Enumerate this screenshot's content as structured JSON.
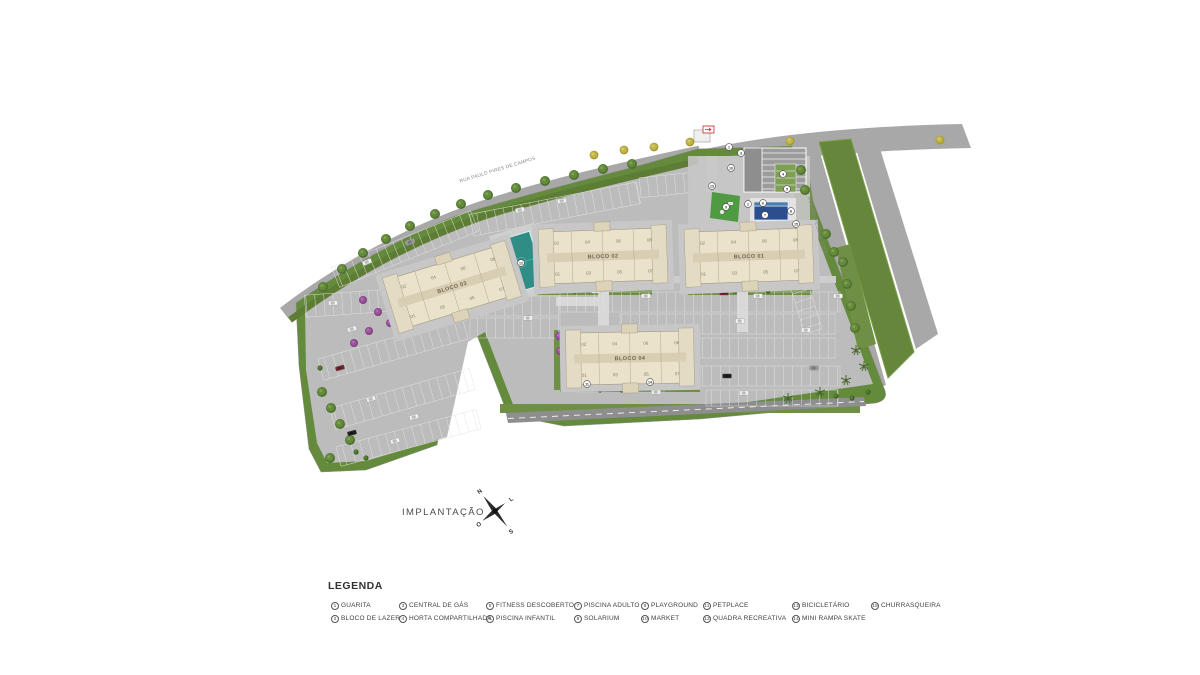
{
  "title": "IMPLANTAÇÃO",
  "compass": {
    "n": "N",
    "e": "L",
    "s": "S",
    "w": "O"
  },
  "streets": [
    {
      "name": "RUA PAULO PIRES DE CAMPOS"
    },
    {
      "name": "RUA PROFESSOR DOLE"
    }
  ],
  "blocks": [
    {
      "name": "BLOCO 01",
      "units_top": [
        "02",
        "04",
        "06",
        "08"
      ],
      "units_bottom": [
        "01",
        "03",
        "05",
        "07"
      ]
    },
    {
      "name": "BLOCO 02",
      "units_top": [
        "02",
        "04",
        "06",
        "08"
      ],
      "units_bottom": [
        "01",
        "03",
        "05",
        "07"
      ]
    },
    {
      "name": "BLOCO 03",
      "units_top": [
        "02",
        "04",
        "06",
        "08"
      ],
      "units_bottom": [
        "01",
        "03",
        "05",
        "07"
      ]
    },
    {
      "name": "BLOCO 04",
      "units_top": [
        "02",
        "04",
        "06",
        "08"
      ],
      "units_bottom": [
        "01",
        "03",
        "05",
        "07"
      ]
    }
  ],
  "legend": {
    "heading": "LEGENDA",
    "items": [
      {
        "n": "1",
        "label": "GUARITA"
      },
      {
        "n": "2",
        "label": "BLOCO DE LAZER"
      },
      {
        "n": "3",
        "label": "CENTRAL DE GÁS"
      },
      {
        "n": "4",
        "label": "HORTA COMPARTILHADA"
      },
      {
        "n": "5",
        "label": "FITNESS DESCOBERTO"
      },
      {
        "n": "6",
        "label": "PISCINA INFANTIL"
      },
      {
        "n": "7",
        "label": "PISCINA ADULTO"
      },
      {
        "n": "8",
        "label": "SOLARIUM"
      },
      {
        "n": "9",
        "label": "PLAYGROUND"
      },
      {
        "n": "10",
        "label": "MARKET"
      },
      {
        "n": "11",
        "label": "PETPLACE"
      },
      {
        "n": "12",
        "label": "QUADRA RECREATIVA"
      },
      {
        "n": "13",
        "label": "BICICLETÁRIO"
      },
      {
        "n": "14",
        "label": "MINI RAMPA SKATE"
      },
      {
        "n": "15",
        "label": "CHURRASQUEIRA"
      }
    ]
  },
  "colors": {
    "grass": "#648a3c",
    "grass_dark": "#5d7c34",
    "paving": "#bcbcbc",
    "road": "#a8a8a8",
    "road_dark": "#8e8e8e",
    "building": "#eae2cb",
    "pool": "#2a4e8f",
    "court": "#2f8d85",
    "accent_red": "#cc2222"
  }
}
